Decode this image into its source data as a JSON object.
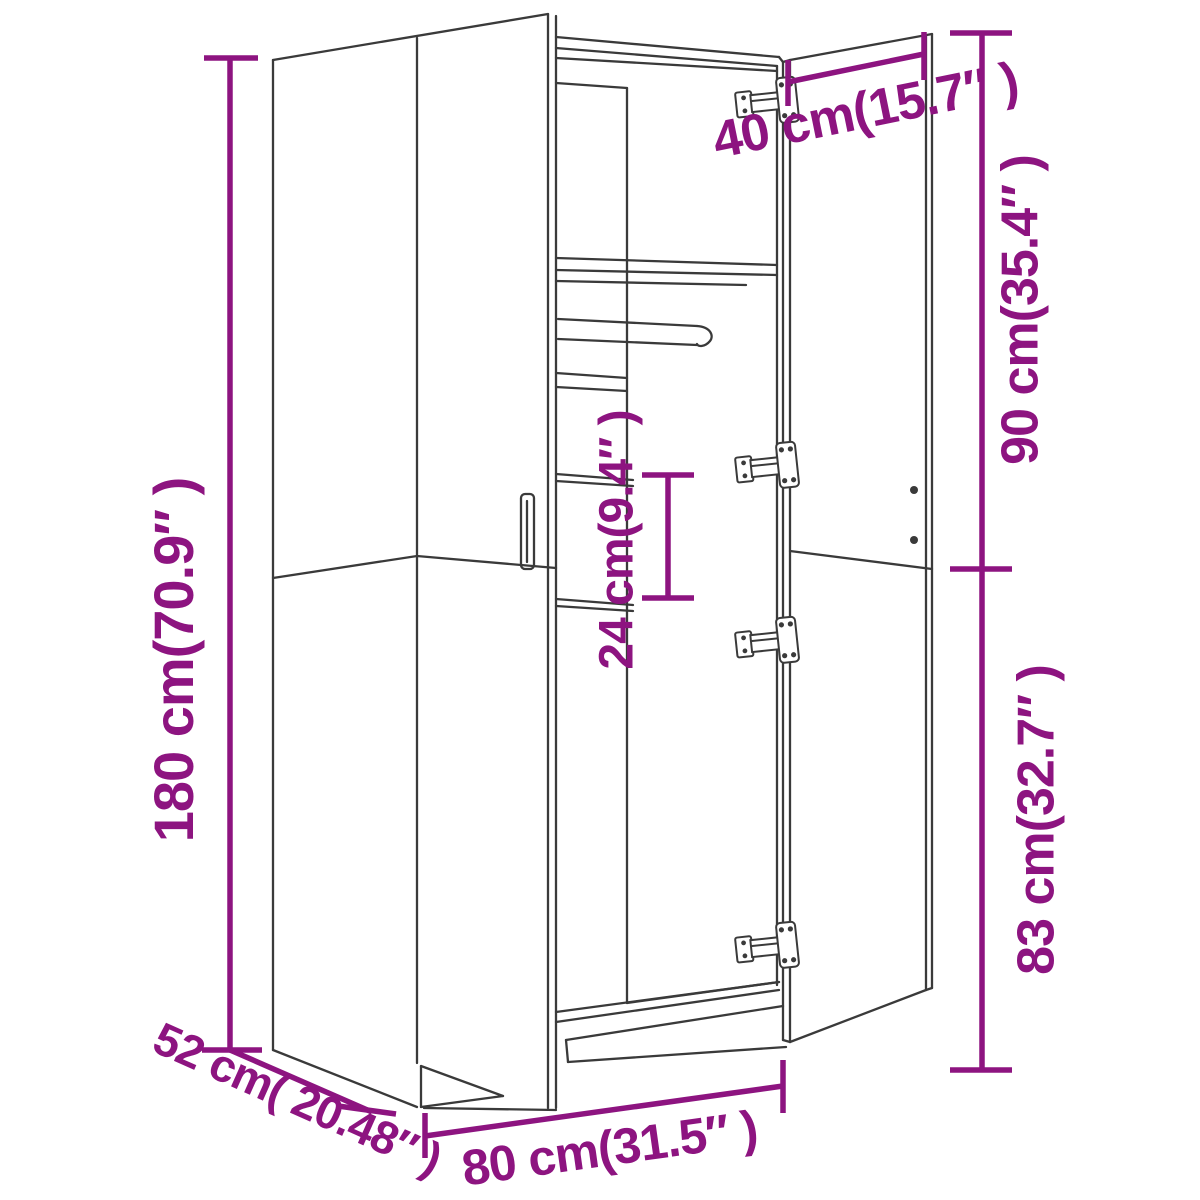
{
  "figure": {
    "description": "Line-art perspective diagram of a two-door wardrobe with both doors open, annotated with purple dimension lines",
    "background_color": "#ffffff",
    "line_color": "#3a3a3a",
    "dimension_color": "#8d1480"
  },
  "dimensions": {
    "height": {
      "label": "180 cm(70.9″ )"
    },
    "depth": {
      "label": "52 cm( 20.48″ )"
    },
    "width": {
      "label": "80 cm(31.5″ )"
    },
    "door_width": {
      "label": "40 cm(15.7″ )"
    },
    "top_section": {
      "label": "90 cm(35.4″ )"
    },
    "bottom_section": {
      "label": "83 cm(32.7″ )"
    },
    "shelf_gap": {
      "label": "24 cm(9.4″ )"
    }
  }
}
